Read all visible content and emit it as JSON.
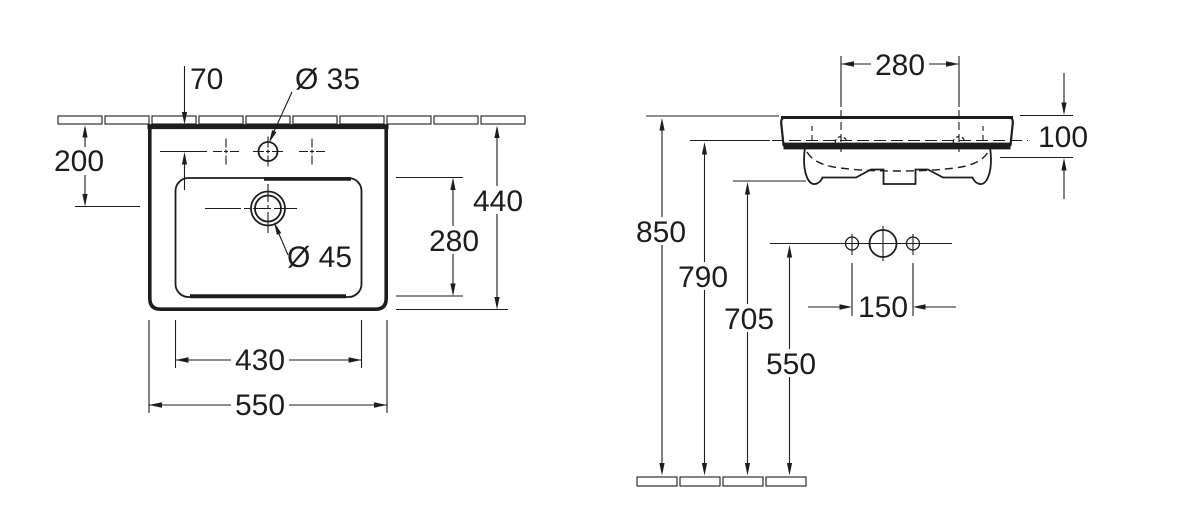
{
  "drawing": {
    "subject": "wall-mounted washbasin technical drawing, plan view and front elevation",
    "line_color": "#1d1d1b",
    "background_color": "#ffffff"
  },
  "plan_view": {
    "dim_tap_offset": "70",
    "dim_tap_hole_dia": "Ø 35",
    "dim_wall_to_drain": "200",
    "dim_overall_depth": "440",
    "dim_bowl_depth": "280",
    "dim_drain_dia": "Ø 45",
    "dim_bowl_width": "430",
    "dim_overall_width": "550"
  },
  "front_view": {
    "dim_fixing_hole_span": "280",
    "dim_front_edge_height": "100",
    "dim_rim_height": "850",
    "dim_fixing_hole_height": "790",
    "dim_underside_height": "705",
    "dim_outlet_height": "550",
    "dim_connection_span": "150"
  }
}
